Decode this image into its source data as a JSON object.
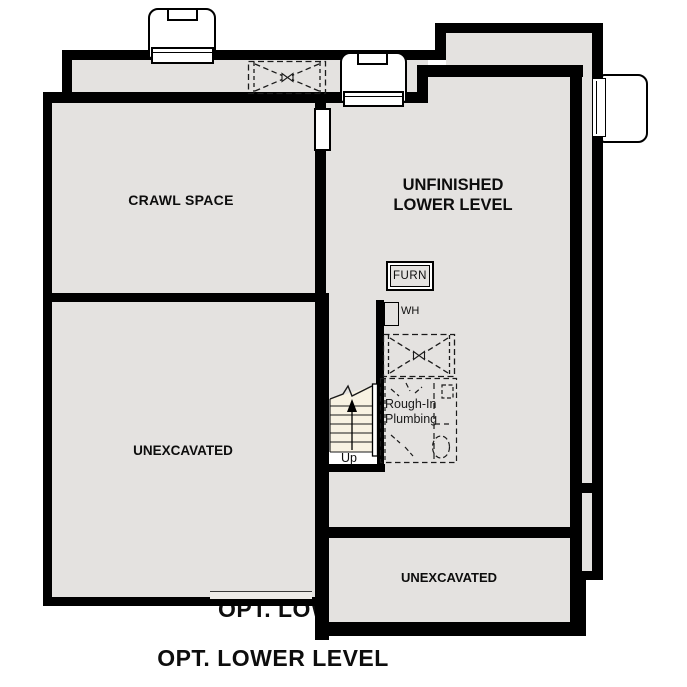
{
  "title": "OPT. LOWER LEVEL",
  "background_title": "OPT. LOWER LEVEL",
  "rooms": {
    "crawl_space": "CRAWL SPACE",
    "unfinished_line1": "UNFINISHED",
    "unfinished_line2": "LOWER LEVEL",
    "unexcavated_left": "UNEXCAVATED",
    "unexcavated_right": "UNEXCAVATED"
  },
  "fixtures": {
    "furnace": "FURN",
    "water_heater": "WH",
    "rough_in_line1": "Rough-In",
    "rough_in_line2": "Plumbing",
    "stairs_direction": "Up"
  },
  "colors": {
    "wall": "#000000",
    "room_fill": "#e4e2e0",
    "stair_fill": "#f8f2e2",
    "outside": "#ffffff",
    "text": "#0d0d0d"
  }
}
